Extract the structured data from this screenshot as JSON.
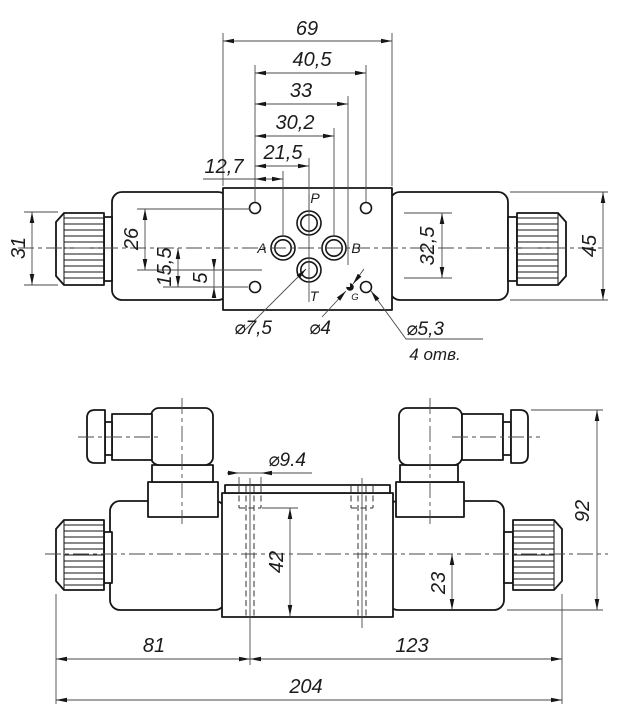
{
  "view_top": {
    "dimensions": {
      "total_width": "69",
      "hole_pitch": "40,5",
      "dim_33": "33",
      "dim_30_2": "30,2",
      "dim_21_5": "21,5",
      "dim_12_7": "12,7",
      "knob_od": "31",
      "dim_26": "26",
      "dim_15_5": "15,5",
      "dim_5": "5",
      "dim_32_5": "32,5",
      "solenoid_od": "45"
    },
    "port_labels": {
      "p": "P",
      "a": "A",
      "b": "B",
      "t": "T",
      "g": "G"
    },
    "callouts": {
      "t_hole_dia": "⌀7,5",
      "g_hole_dia": "⌀4",
      "mount_hole_dia": "⌀5,3",
      "mount_hole_note": "4 отв."
    }
  },
  "view_front": {
    "dimensions": {
      "stud_dia": "⌀9.4",
      "dim_42": "42",
      "dim_23": "23",
      "dim_81": "81",
      "dim_123": "123",
      "overall_length": "204",
      "overall_height": "92"
    }
  }
}
